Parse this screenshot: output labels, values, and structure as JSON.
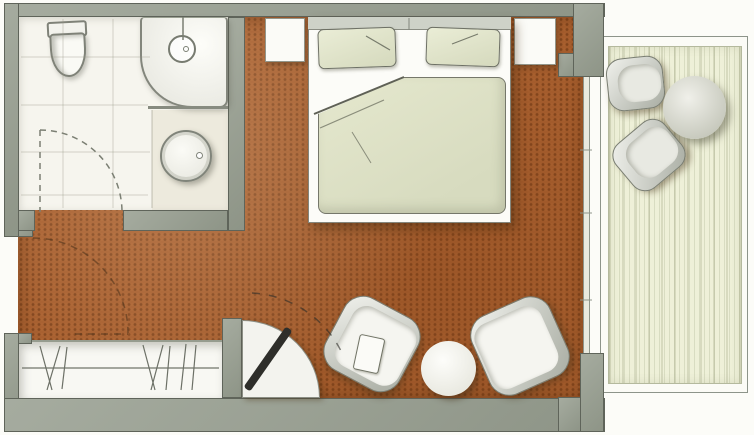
{
  "document": {
    "kind": "hand-drawn hotel room floor plan",
    "orientation": "landscape",
    "visible_text": "none"
  },
  "colors": {
    "paper": "#fcfcf8",
    "wall": "#99a092",
    "wall_outline": "#5f645a",
    "carpet": "#aa6130",
    "carpet_dot": "#5c2c0e",
    "bathfloor": "#f6f5ee",
    "deck": "#eef0d8",
    "deck_stripe": "#9ba079",
    "fabric": "#e0e3c8",
    "white_furniture": "#f8f8f3",
    "tv": "#2e2e2a",
    "line": "#70746a"
  },
  "rooms": [
    {
      "name": "bathroom",
      "position": "top-left",
      "fixtures": [
        "toilet",
        "corner-shower",
        "round-washbasin"
      ]
    },
    {
      "name": "bedroom",
      "position": "center",
      "floor": "brown carpet"
    },
    {
      "name": "wardrobe-niche",
      "position": "bottom-left",
      "symbols": [
        "hanging-rail",
        "clothes-hangers"
      ]
    },
    {
      "name": "balcony",
      "position": "right",
      "floor": "pale wood decking"
    }
  ],
  "furniture": [
    {
      "name": "double-bed",
      "items": [
        "headboard",
        "pillow-left",
        "pillow-right",
        "duvet-with-folded-corner"
      ]
    },
    {
      "name": "nightstand-left"
    },
    {
      "name": "nightstand-right"
    },
    {
      "name": "tv-on-quarter-round-stand",
      "annotation": "dashed swivel arc"
    },
    {
      "name": "armchair-left",
      "with": "seat-cushion"
    },
    {
      "name": "armchair-right"
    },
    {
      "name": "round-coffee-table"
    },
    {
      "name": "balcony-chair-top"
    },
    {
      "name": "balcony-chair-bottom"
    },
    {
      "name": "balcony-round-table"
    }
  ],
  "doors": [
    {
      "name": "entry-door",
      "wall": "left",
      "swing": "dashed quarter arc into bedroom"
    },
    {
      "name": "bathroom-door",
      "wall": "bathroom-south",
      "swing": "dashed quarter arc into bathroom"
    }
  ],
  "window": {
    "name": "balcony-glazing",
    "style": "double thin line with ticks"
  }
}
